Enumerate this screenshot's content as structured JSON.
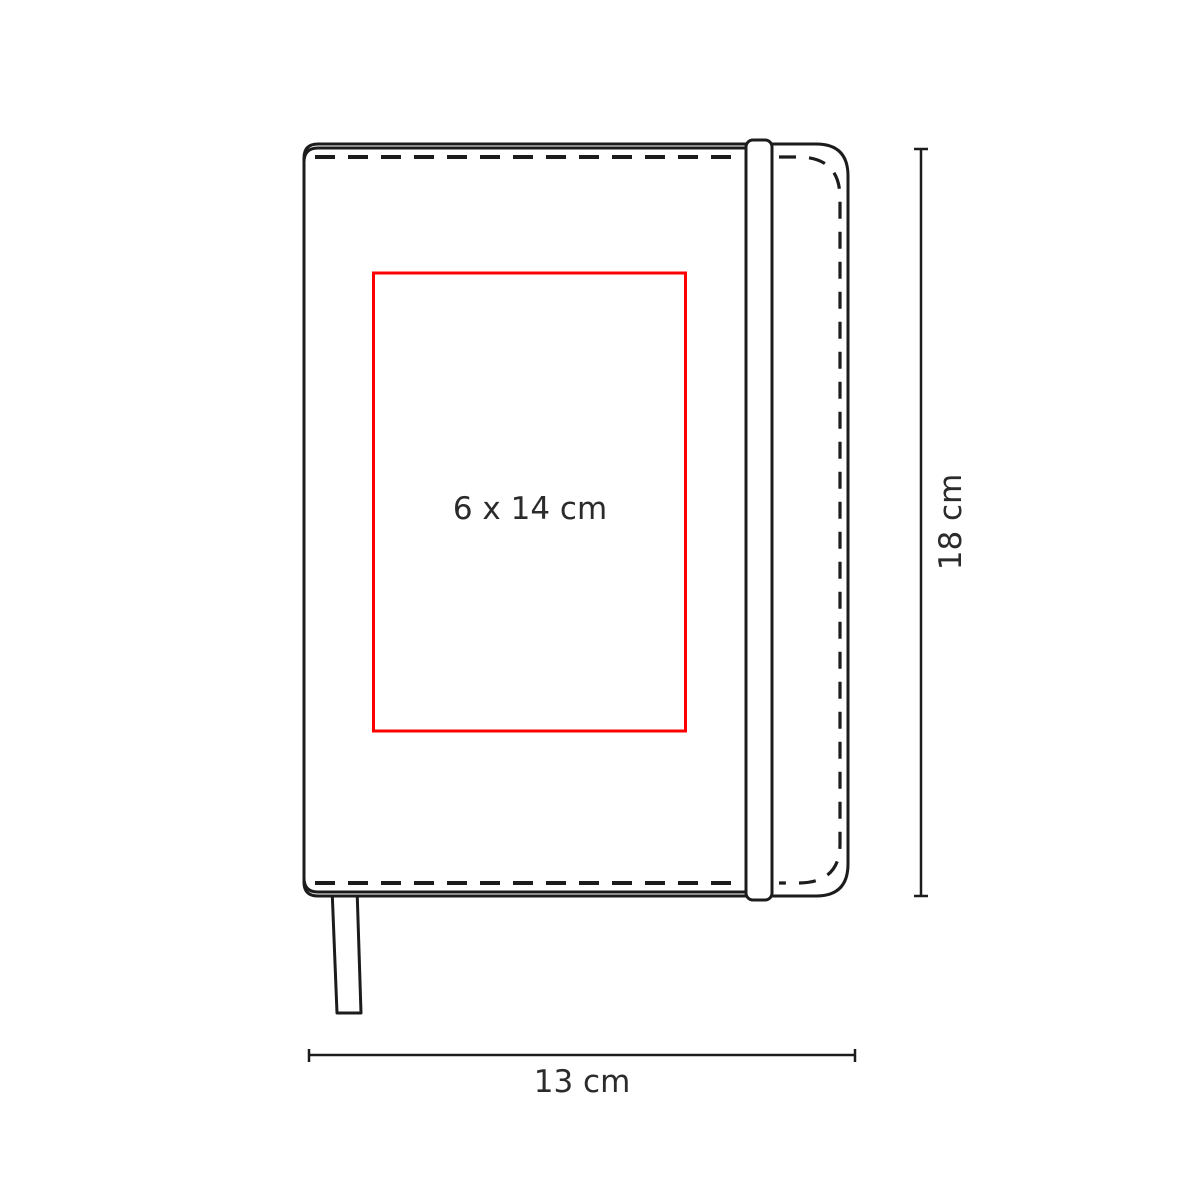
{
  "labels": {
    "print_area": "6 x 14 cm",
    "width": "13 cm",
    "height": "18 cm"
  },
  "colors": {
    "outline": "#1c1c1c",
    "print_area": "#fe0000",
    "text": "#2b2b2b",
    "background": "#ffffff"
  }
}
